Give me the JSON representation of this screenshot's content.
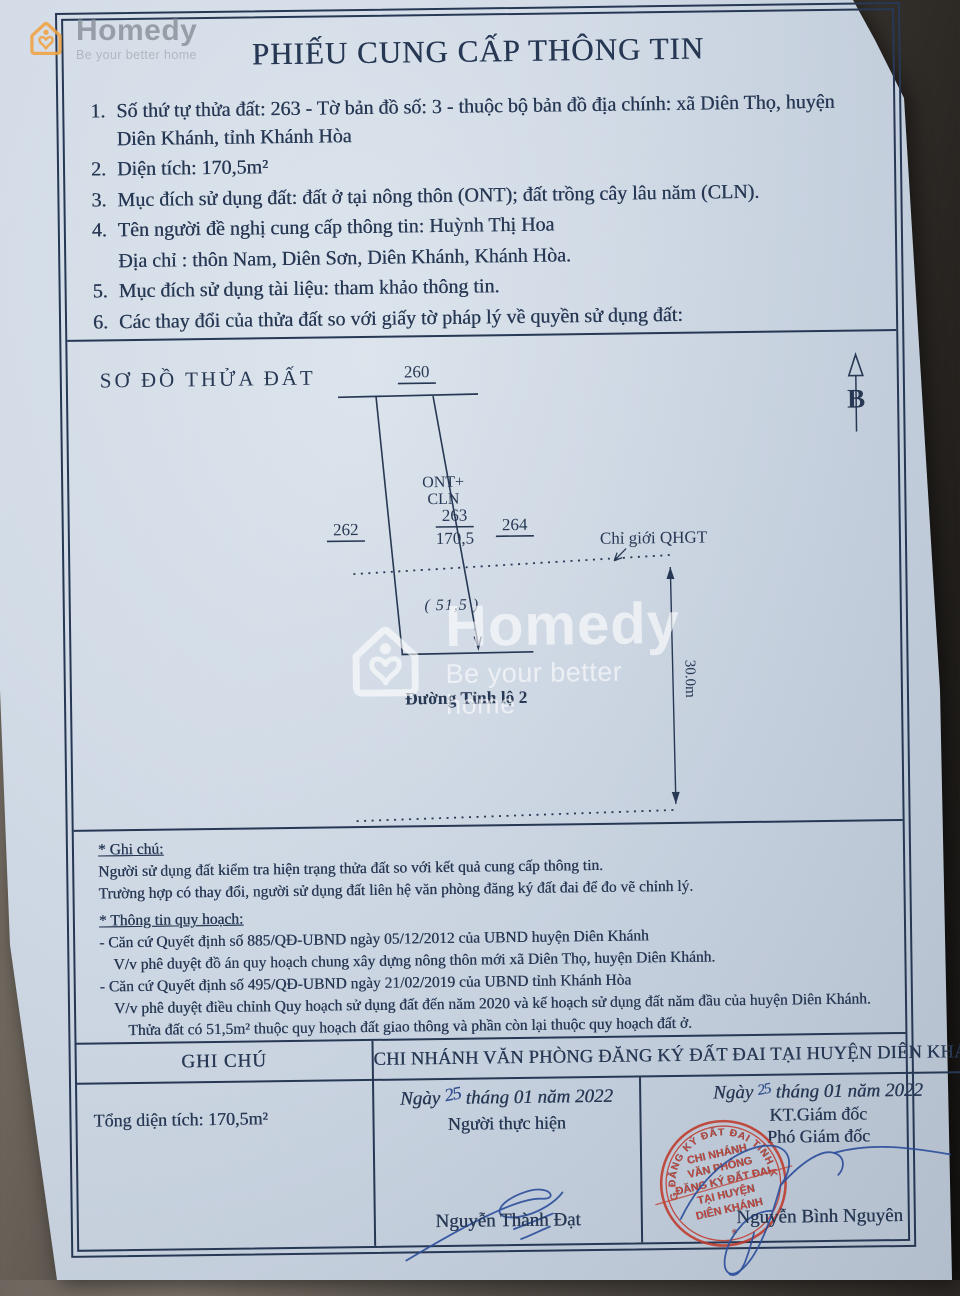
{
  "colors": {
    "ink": "#273854",
    "stamp_red": "#bf3a2c",
    "signature_blue": "#2e4f9b",
    "brand_orange": "#f2a13d",
    "paper": "#d2dce7"
  },
  "watermark": {
    "brand": "Homedy",
    "tagline": "Be your better home"
  },
  "doc": {
    "title": "PHIẾU CUNG CẤP THÔNG TIN",
    "items": [
      {
        "num": "1.",
        "text": "Số thứ tự thửa đất: 263 - Tờ bản đồ số: 3 -  thuộc bộ bản đồ địa chính: xã Diên Thọ, huyện Diên Khánh, tỉnh Khánh Hòa"
      },
      {
        "num": "2.",
        "text": "Diện tích: 170,5m²"
      },
      {
        "num": "3.",
        "text": "Mục đích sử dụng đất: đất ở tại nông thôn (ONT); đất trồng cây lâu năm (CLN)."
      },
      {
        "num": "4.",
        "text": "Tên người đề nghị cung cấp thông tin: Huỳnh Thị Hoa"
      },
      {
        "num": "",
        "text": "Địa chỉ : thôn Nam, Diên Sơn, Diên Khánh, Khánh Hòa."
      },
      {
        "num": "5.",
        "text": "Mục đích sử dụng tài liệu: tham khảo thông tin."
      },
      {
        "num": "6.",
        "text": "Các thay đổi của thửa đất so với giấy tờ pháp lý về quyền sử dụng đất:"
      }
    ]
  },
  "diagram": {
    "heading": "SƠ ĐỒ THỬA ĐẤT",
    "north_label": "B",
    "parcel_top": "260",
    "parcel_left": "262",
    "parcel_right": "264",
    "parcel_no": "263",
    "parcel_area": "170,5",
    "land_use_1": "ONT+",
    "land_use_2": "CLN",
    "frontage": "( 51,5 )",
    "qhgt_label": "Chỉ giới QHGT",
    "road_name": "Đường Tỉnh lộ 2",
    "depth_label": "30.0m"
  },
  "notes": {
    "ghi_chu_heading": "* Ghi chú:",
    "ghi_chu_1": "Người sử dụng đất kiểm tra hiện trạng thửa đất so với kết quả cung cấp thông tin.",
    "ghi_chu_2": "Trường hợp có thay đổi, người sử dụng đất liên hệ văn phòng đăng ký đất đai để đo vẽ chỉnh lý.",
    "quy_hoach_heading": "* Thông tin quy hoạch:",
    "qh_1": "- Căn cứ Quyết định số 885/QĐ-UBND ngày 05/12/2012 của UBND huyện Diên Khánh",
    "qh_2": "V/v phê duyệt đồ án quy hoạch chung xây dựng nông thôn mới xã Diên Thọ, huyện Diên Khánh.",
    "qh_3": "- Căn cứ Quyết định số 495/QĐ-UBND ngày 21/02/2019 của UBND tỉnh Khánh Hòa",
    "qh_4": "V/v phê duyệt điều chỉnh Quy hoạch sử dụng đất đến năm 2020 và kế hoạch sử dụng đất năm đầu của huyện Diên Khánh.",
    "qh_5": "Thửa đất có 51,5m² thuộc quy hoạch đất giao thông và phần còn lại thuộc quy hoạch đất ở."
  },
  "table": {
    "col1_header": "GHI CHÚ",
    "office_header": "CHI NHÁNH VĂN PHÒNG ĐĂNG KÝ ĐẤT ĐAI TẠI HUYỆN DIÊN KHÁNH",
    "total_area": "Tổng diện tích: 170,5m²",
    "executor": {
      "date_pre": "Ngày",
      "day": "25",
      "date_post": "tháng 01 năm 2022",
      "role": "Người thực hiện",
      "name": "Nguyễn Thành Đạt"
    },
    "director": {
      "date_pre": "Ngày",
      "day": "25",
      "date_post": "tháng 01 năm 2022",
      "role1": "KT.Giám đốc",
      "role2": "Phó Giám đốc",
      "name": "Nguyễn Bình Nguyên"
    },
    "stamp": {
      "ring_text": "VĂN PHÒNG ĐĂNG KÝ ĐẤT ĐAI TỈNH KHÁNH HÒA",
      "star": "✳",
      "center_1": "CHI NHÁNH",
      "center_2": "VĂN PHÒNG",
      "center_3": "ĐĂNG KÝ ĐẤT ĐAI",
      "center_4": "TẠI HUYỆN",
      "center_5": "DIÊN KHÁNH"
    }
  }
}
